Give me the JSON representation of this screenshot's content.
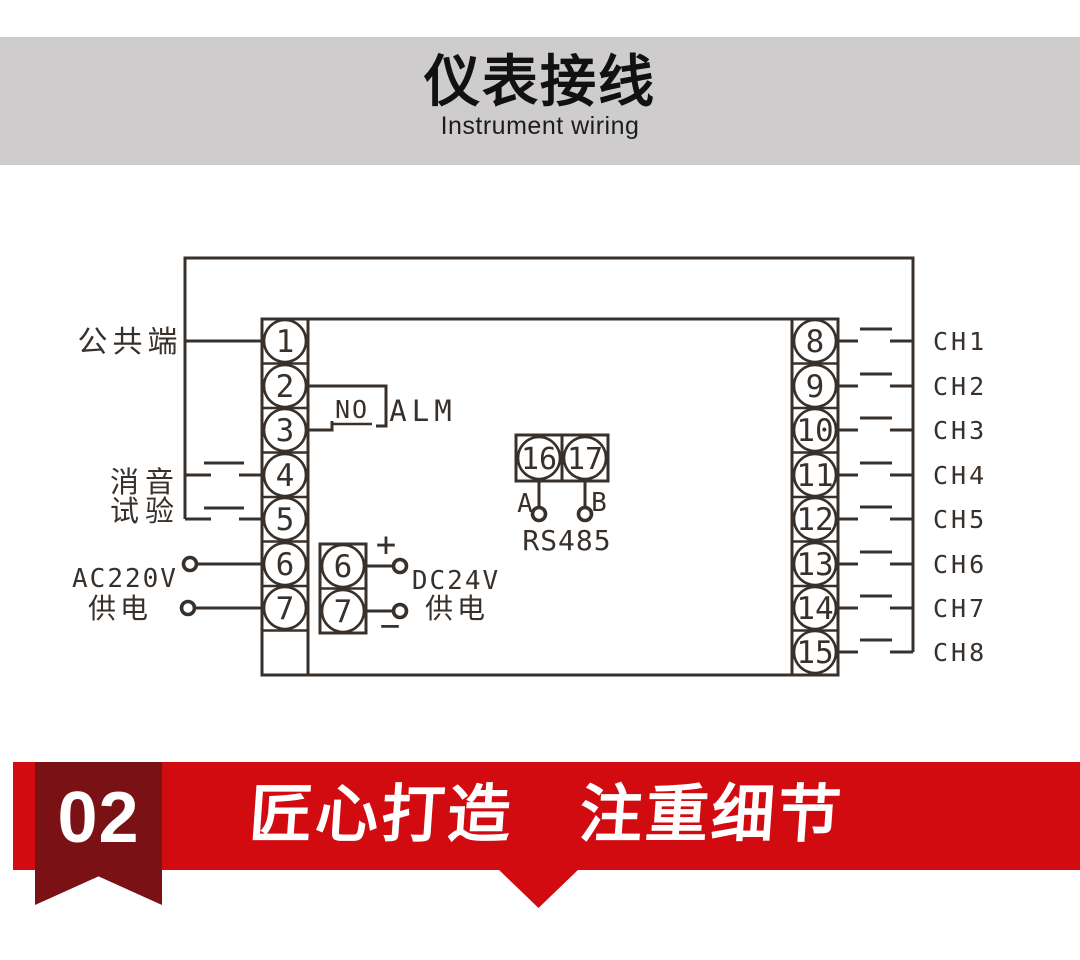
{
  "header": {
    "title": "仪表接线",
    "subtitle": "Instrument wiring"
  },
  "diagram": {
    "labels": {
      "common": "公共端",
      "mute": "消音",
      "test": "试验",
      "ac_power_line1": "AC220V",
      "ac_power_line2": "供电",
      "relay_no": "NO",
      "relay_alm": "ALM",
      "dc_plus": "+",
      "dc_minus": "−",
      "dc_power_line1": "DC24V",
      "dc_power_line2": "供电",
      "rs485_a": "A",
      "rs485_b": "B",
      "rs485": "RS485"
    },
    "left_terminals": [
      "1",
      "2",
      "3",
      "4",
      "5",
      "6",
      "7"
    ],
    "dc_terminals": [
      "6",
      "7"
    ],
    "comm_terminals": [
      "16",
      "17"
    ],
    "right_terminals": [
      "8",
      "9",
      "10",
      "11",
      "12",
      "13",
      "14",
      "15"
    ],
    "channels": [
      "CH1",
      "CH2",
      "CH3",
      "CH4",
      "CH5",
      "CH6",
      "CH7",
      "CH8"
    ]
  },
  "banner": {
    "number": "02",
    "slogan": "匠心打造　注重细节"
  },
  "colors": {
    "band_gray": "#cecccc",
    "red": "#d20b10",
    "dark_red": "#7a1115",
    "ink": "#38302b"
  }
}
